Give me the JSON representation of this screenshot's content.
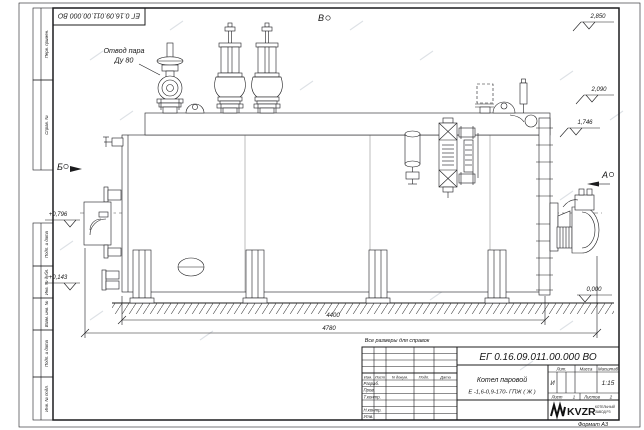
{
  "sheet": {
    "stamp_designation": "ЕГ 0.16.09.011.00.000  ВО",
    "format_note": "Формат А3",
    "margin_labels": [
      "Перв. примен.",
      "Справ. №",
      "Подп. и дата",
      "Инв. № дубл.",
      "Взам. инв. №",
      "Подп. и дата",
      "Инв. № подл."
    ]
  },
  "drawing": {
    "callout": {
      "line1": "Отвод пара",
      "line2": "Ду 80"
    },
    "views": {
      "a": "А",
      "b": "Б",
      "v": "В"
    },
    "elevations": {
      "top": "2,850",
      "mid": "2,090",
      "drum_top": "1,746",
      "left_upper": "+0,796",
      "left_lower": "+0,143",
      "ground": "0,000"
    },
    "dimensions": {
      "body_length": "4400",
      "overall_length": "4780"
    },
    "note": "Все размеры для справок"
  },
  "title_block": {
    "designation": "ЕГ 0.16.09.011.00.000  ВО",
    "product_name": "Котел паровой",
    "product_type": "Е -1,6-0,9-170- ГПЖ ( Ж )",
    "columns": {
      "izm": "Изм.",
      "list": "Лист",
      "doc": "N докум.",
      "sign": "Подп.",
      "date": "Дата"
    },
    "rows": {
      "developed": "Разраб.",
      "checked": "Пров.",
      "tcontrol": "Т.контр.",
      "ncontrol": "Н.контр.",
      "approved": "Утв."
    },
    "props": {
      "lit_label": "Лит.",
      "mass_label": "Масса",
      "scale_label": "Масштаб",
      "lit_value": "И",
      "scale_value": "1:15",
      "sheet_label": "Лист",
      "sheet_value": "1",
      "sheets_label": "Листов",
      "sheets_value": "2"
    },
    "company": {
      "logo": "KVZR",
      "caption1": "КОТЕЛЬНЫЙ",
      "caption2": "ЗАВОД РЗ"
    }
  }
}
